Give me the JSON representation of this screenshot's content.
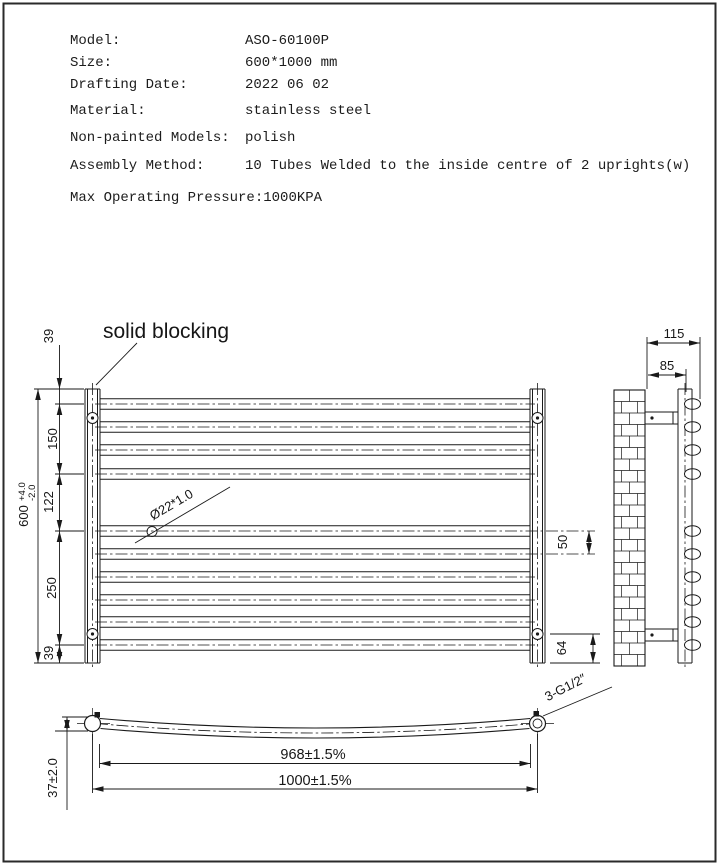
{
  "specs": {
    "rows": [
      {
        "label": "Model:",
        "value": "ASO-60100P"
      },
      {
        "label": "Size:",
        "value": "600*1000 mm"
      },
      {
        "label": "Drafting Date:",
        "value": "2022 06 02"
      },
      {
        "label": "Material:",
        "value": "stainless steel"
      },
      {
        "label": "Non-painted Models:",
        "value": "polish"
      },
      {
        "label": "Assembly Method:",
        "value": "10 Tubes Welded to the inside centre of 2 uprights(w)"
      },
      {
        "label": "Max Operating Pressure:",
        "value": "1000KPA"
      }
    ]
  },
  "front_view": {
    "callout_solid_blocking": "solid blocking",
    "tube_spec": "Ø22*1.0",
    "dims": {
      "top_offset": "39",
      "upper_span": "150",
      "mid_gap": "122",
      "lower_span": "250",
      "bottom_offset": "39",
      "overall_height": "600",
      "tol_plus": "+4.0",
      "tol_minus": "-2.0",
      "tube_pitch": "50",
      "bracket_offset": "64"
    }
  },
  "side_view": {
    "dims": {
      "depth_overall": "115",
      "depth_to_rail": "85"
    }
  },
  "bottom_view": {
    "dims": {
      "bow_depth": "37±2.0",
      "inner_width": "968±1.5%",
      "overall_width": "1000±1.5%"
    },
    "thread_spec": "3-G1/2″"
  },
  "colors": {
    "line": "#1a1a1a",
    "background": "#ffffff"
  }
}
